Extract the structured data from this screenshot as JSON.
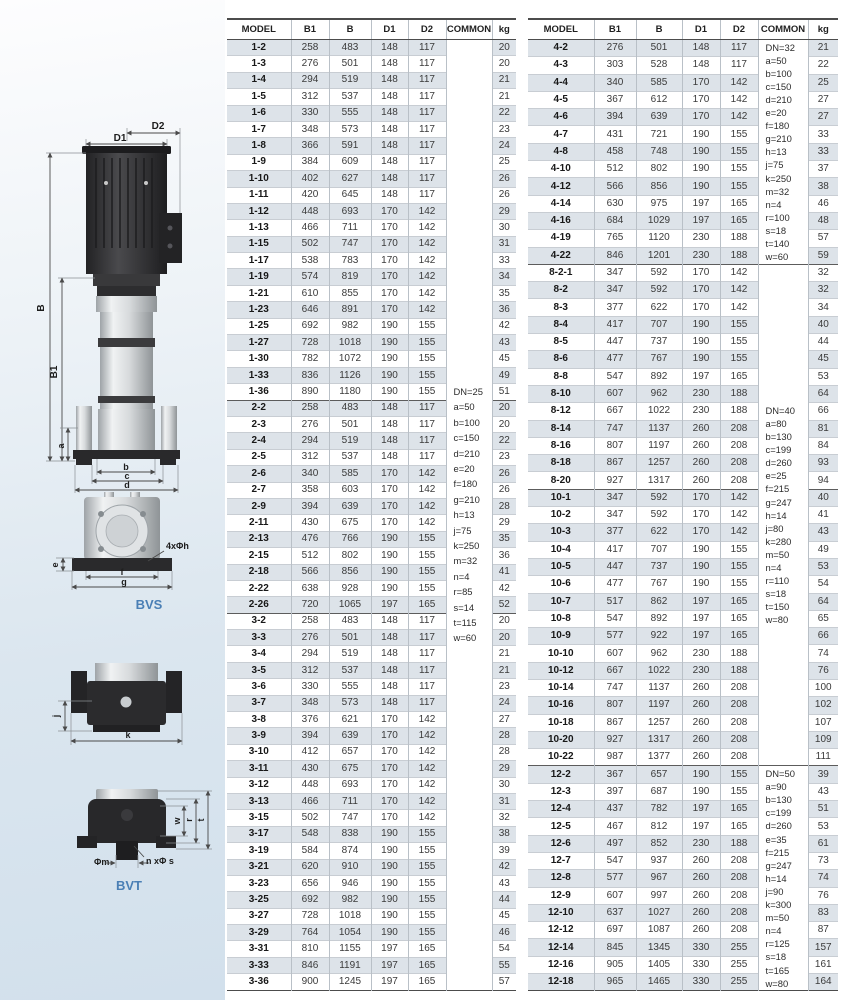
{
  "colors": {
    "accent_blue": "#4a7fb5",
    "row_shade": "#dde3e9",
    "panel_blue": "#d2e0ec"
  },
  "diagrams": {
    "bvs_label": "BVS",
    "bvt_label": "BVT",
    "labels": {
      "d2": "D2",
      "d1": "D1",
      "b_total": "B",
      "b1": "B1",
      "a": "a",
      "b": "b",
      "c": "c",
      "d": "d",
      "e": "e",
      "f": "f",
      "g": "g",
      "bolt_holes": "4xΦh",
      "j": "j",
      "k": "k",
      "w": "w",
      "r": "r",
      "t": "t",
      "phi_m": "Φm",
      "n_phi_s": "n xΦ s"
    }
  },
  "left_table": {
    "headers": [
      "MODEL",
      "B1",
      "B",
      "D1",
      "D2",
      "COMMON",
      "kg"
    ],
    "group_starts": [
      22,
      35
    ],
    "common_blocks": [
      {
        "start": 0,
        "span": 58,
        "lines": [
          "DN=25",
          "a=50",
          "b=100",
          "c=150",
          "d=210",
          "e=20",
          "f=180",
          "g=210",
          "h=13",
          "j=75",
          "k=250",
          "m=32",
          "n=4",
          "r=85",
          "s=14",
          "t=115",
          "w=60"
        ]
      }
    ],
    "rows": [
      [
        "1-2",
        258,
        483,
        148,
        117,
        20
      ],
      [
        "1-3",
        276,
        501,
        148,
        117,
        20
      ],
      [
        "1-4",
        294,
        519,
        148,
        117,
        21
      ],
      [
        "1-5",
        312,
        537,
        148,
        117,
        21
      ],
      [
        "1-6",
        330,
        555,
        148,
        117,
        22
      ],
      [
        "1-7",
        348,
        573,
        148,
        117,
        23
      ],
      [
        "1-8",
        366,
        591,
        148,
        117,
        24
      ],
      [
        "1-9",
        384,
        609,
        148,
        117,
        25
      ],
      [
        "1-10",
        402,
        627,
        148,
        117,
        26
      ],
      [
        "1-11",
        420,
        645,
        148,
        117,
        26
      ],
      [
        "1-12",
        448,
        693,
        170,
        142,
        29
      ],
      [
        "1-13",
        466,
        711,
        170,
        142,
        30
      ],
      [
        "1-15",
        502,
        747,
        170,
        142,
        31
      ],
      [
        "1-17",
        538,
        783,
        170,
        142,
        33
      ],
      [
        "1-19",
        574,
        819,
        170,
        142,
        34
      ],
      [
        "1-21",
        610,
        855,
        170,
        142,
        35
      ],
      [
        "1-23",
        646,
        891,
        170,
        142,
        36
      ],
      [
        "1-25",
        692,
        982,
        190,
        155,
        42
      ],
      [
        "1-27",
        728,
        1018,
        190,
        155,
        43
      ],
      [
        "1-30",
        782,
        1072,
        190,
        155,
        45
      ],
      [
        "1-33",
        836,
        1126,
        190,
        155,
        49
      ],
      [
        "1-36",
        890,
        1180,
        190,
        155,
        51
      ],
      [
        "2-2",
        258,
        483,
        148,
        117,
        20
      ],
      [
        "2-3",
        276,
        501,
        148,
        117,
        20
      ],
      [
        "2-4",
        294,
        519,
        148,
        117,
        22
      ],
      [
        "2-5",
        312,
        537,
        148,
        117,
        23
      ],
      [
        "2-6",
        340,
        585,
        170,
        142,
        26
      ],
      [
        "2-7",
        358,
        603,
        170,
        142,
        26
      ],
      [
        "2-9",
        394,
        639,
        170,
        142,
        28
      ],
      [
        "2-11",
        430,
        675,
        170,
        142,
        29
      ],
      [
        "2-13",
        476,
        766,
        190,
        155,
        35
      ],
      [
        "2-15",
        512,
        802,
        190,
        155,
        36
      ],
      [
        "2-18",
        566,
        856,
        190,
        155,
        41
      ],
      [
        "2-22",
        638,
        928,
        190,
        155,
        42
      ],
      [
        "2-26",
        720,
        1065,
        197,
        165,
        52
      ],
      [
        "3-2",
        258,
        483,
        148,
        117,
        20
      ],
      [
        "3-3",
        276,
        501,
        148,
        117,
        20
      ],
      [
        "3-4",
        294,
        519,
        148,
        117,
        21
      ],
      [
        "3-5",
        312,
        537,
        148,
        117,
        21
      ],
      [
        "3-6",
        330,
        555,
        148,
        117,
        23
      ],
      [
        "3-7",
        348,
        573,
        148,
        117,
        24
      ],
      [
        "3-8",
        376,
        621,
        170,
        142,
        27
      ],
      [
        "3-9",
        394,
        639,
        170,
        142,
        28
      ],
      [
        "3-10",
        412,
        657,
        170,
        142,
        28
      ],
      [
        "3-11",
        430,
        675,
        170,
        142,
        29
      ],
      [
        "3-12",
        448,
        693,
        170,
        142,
        30
      ],
      [
        "3-13",
        466,
        711,
        170,
        142,
        31
      ],
      [
        "3-15",
        502,
        747,
        170,
        142,
        32
      ],
      [
        "3-17",
        548,
        838,
        190,
        155,
        38
      ],
      [
        "3-19",
        584,
        874,
        190,
        155,
        39
      ],
      [
        "3-21",
        620,
        910,
        190,
        155,
        42
      ],
      [
        "3-23",
        656,
        946,
        190,
        155,
        43
      ],
      [
        "3-25",
        692,
        982,
        190,
        155,
        44
      ],
      [
        "3-27",
        728,
        1018,
        190,
        155,
        45
      ],
      [
        "3-29",
        764,
        1054,
        190,
        155,
        46
      ],
      [
        "3-31",
        810,
        1155,
        197,
        165,
        54
      ],
      [
        "3-33",
        846,
        1191,
        197,
        165,
        55
      ],
      [
        "3-36",
        900,
        1245,
        197,
        165,
        57
      ]
    ]
  },
  "right_table": {
    "headers": [
      "MODEL",
      "B1",
      "B",
      "D1",
      "D2",
      "COMMON",
      "kg"
    ],
    "group_starts": [
      13,
      26,
      42
    ],
    "common_blocks": [
      {
        "start": 0,
        "span": 13,
        "lines": [
          "DN=32",
          "a=50",
          "b=100",
          "c=150",
          "d=210",
          "e=20",
          "f=180",
          "g=210",
          "h=13",
          "j=75",
          "k=250",
          "m=32",
          "n=4",
          "r=100",
          "s=18",
          "t=140",
          "w=60"
        ]
      },
      {
        "start": 13,
        "span": 29,
        "lines": [
          "DN=40",
          "a=80",
          "b=130",
          "c=199",
          "d=260",
          "e=25",
          "f=215",
          "g=247",
          "h=14",
          "j=80",
          "k=280",
          "m=50",
          "n=4",
          "r=110",
          "s=18",
          "t=150",
          "w=80"
        ]
      },
      {
        "start": 42,
        "span": 13,
        "lines": [
          "DN=50",
          "a=90",
          "b=130",
          "c=199",
          "d=260",
          "e=35",
          "f=215",
          "g=247",
          "h=14",
          "j=90",
          "k=300",
          "m=50",
          "n=4",
          "r=125",
          "s=18",
          "t=165",
          "w=80"
        ]
      }
    ],
    "rows": [
      [
        "4-2",
        276,
        501,
        148,
        117,
        21
      ],
      [
        "4-3",
        303,
        528,
        148,
        117,
        22
      ],
      [
        "4-4",
        340,
        585,
        170,
        142,
        25
      ],
      [
        "4-5",
        367,
        612,
        170,
        142,
        27
      ],
      [
        "4-6",
        394,
        639,
        170,
        142,
        27
      ],
      [
        "4-7",
        431,
        721,
        190,
        155,
        33
      ],
      [
        "4-8",
        458,
        748,
        190,
        155,
        33
      ],
      [
        "4-10",
        512,
        802,
        190,
        155,
        37
      ],
      [
        "4-12",
        566,
        856,
        190,
        155,
        38
      ],
      [
        "4-14",
        630,
        975,
        197,
        165,
        46
      ],
      [
        "4-16",
        684,
        1029,
        197,
        165,
        48
      ],
      [
        "4-19",
        765,
        1120,
        230,
        188,
        57
      ],
      [
        "4-22",
        846,
        1201,
        230,
        188,
        59
      ],
      [
        "8-2-1",
        347,
        592,
        170,
        142,
        32
      ],
      [
        "8-2",
        347,
        592,
        170,
        142,
        32
      ],
      [
        "8-3",
        377,
        622,
        170,
        142,
        34
      ],
      [
        "8-4",
        417,
        707,
        190,
        155,
        40
      ],
      [
        "8-5",
        447,
        737,
        190,
        155,
        44
      ],
      [
        "8-6",
        477,
        767,
        190,
        155,
        45
      ],
      [
        "8-8",
        547,
        892,
        197,
        165,
        53
      ],
      [
        "8-10",
        607,
        962,
        230,
        188,
        64
      ],
      [
        "8-12",
        667,
        1022,
        230,
        188,
        66
      ],
      [
        "8-14",
        747,
        1137,
        260,
        208,
        81
      ],
      [
        "8-16",
        807,
        1197,
        260,
        208,
        84
      ],
      [
        "8-18",
        867,
        1257,
        260,
        208,
        93
      ],
      [
        "8-20",
        927,
        1317,
        260,
        208,
        94
      ],
      [
        "10-1",
        347,
        592,
        170,
        142,
        40
      ],
      [
        "10-2",
        347,
        592,
        170,
        142,
        41
      ],
      [
        "10-3",
        377,
        622,
        170,
        142,
        43
      ],
      [
        "10-4",
        417,
        707,
        190,
        155,
        49
      ],
      [
        "10-5",
        447,
        737,
        190,
        155,
        53
      ],
      [
        "10-6",
        477,
        767,
        190,
        155,
        54
      ],
      [
        "10-7",
        517,
        862,
        197,
        165,
        64
      ],
      [
        "10-8",
        547,
        892,
        197,
        165,
        65
      ],
      [
        "10-9",
        577,
        922,
        197,
        165,
        66
      ],
      [
        "10-10",
        607,
        962,
        230,
        188,
        74
      ],
      [
        "10-12",
        667,
        1022,
        230,
        188,
        76
      ],
      [
        "10-14",
        747,
        1137,
        260,
        208,
        100
      ],
      [
        "10-16",
        807,
        1197,
        260,
        208,
        102
      ],
      [
        "10-18",
        867,
        1257,
        260,
        208,
        107
      ],
      [
        "10-20",
        927,
        1317,
        260,
        208,
        109
      ],
      [
        "10-22",
        987,
        1377,
        260,
        208,
        111
      ],
      [
        "12-2",
        367,
        657,
        190,
        155,
        39
      ],
      [
        "12-3",
        397,
        687,
        190,
        155,
        43
      ],
      [
        "12-4",
        437,
        782,
        197,
        165,
        51
      ],
      [
        "12-5",
        467,
        812,
        197,
        165,
        53
      ],
      [
        "12-6",
        497,
        852,
        230,
        188,
        61
      ],
      [
        "12-7",
        547,
        937,
        260,
        208,
        73
      ],
      [
        "12-8",
        577,
        967,
        260,
        208,
        74
      ],
      [
        "12-9",
        607,
        997,
        260,
        208,
        76
      ],
      [
        "12-10",
        637,
        1027,
        260,
        208,
        83
      ],
      [
        "12-12",
        697,
        1087,
        260,
        208,
        87
      ],
      [
        "12-14",
        845,
        1345,
        330,
        255,
        157
      ],
      [
        "12-16",
        905,
        1405,
        330,
        255,
        161
      ],
      [
        "12-18",
        965,
        1465,
        330,
        255,
        164
      ]
    ]
  }
}
